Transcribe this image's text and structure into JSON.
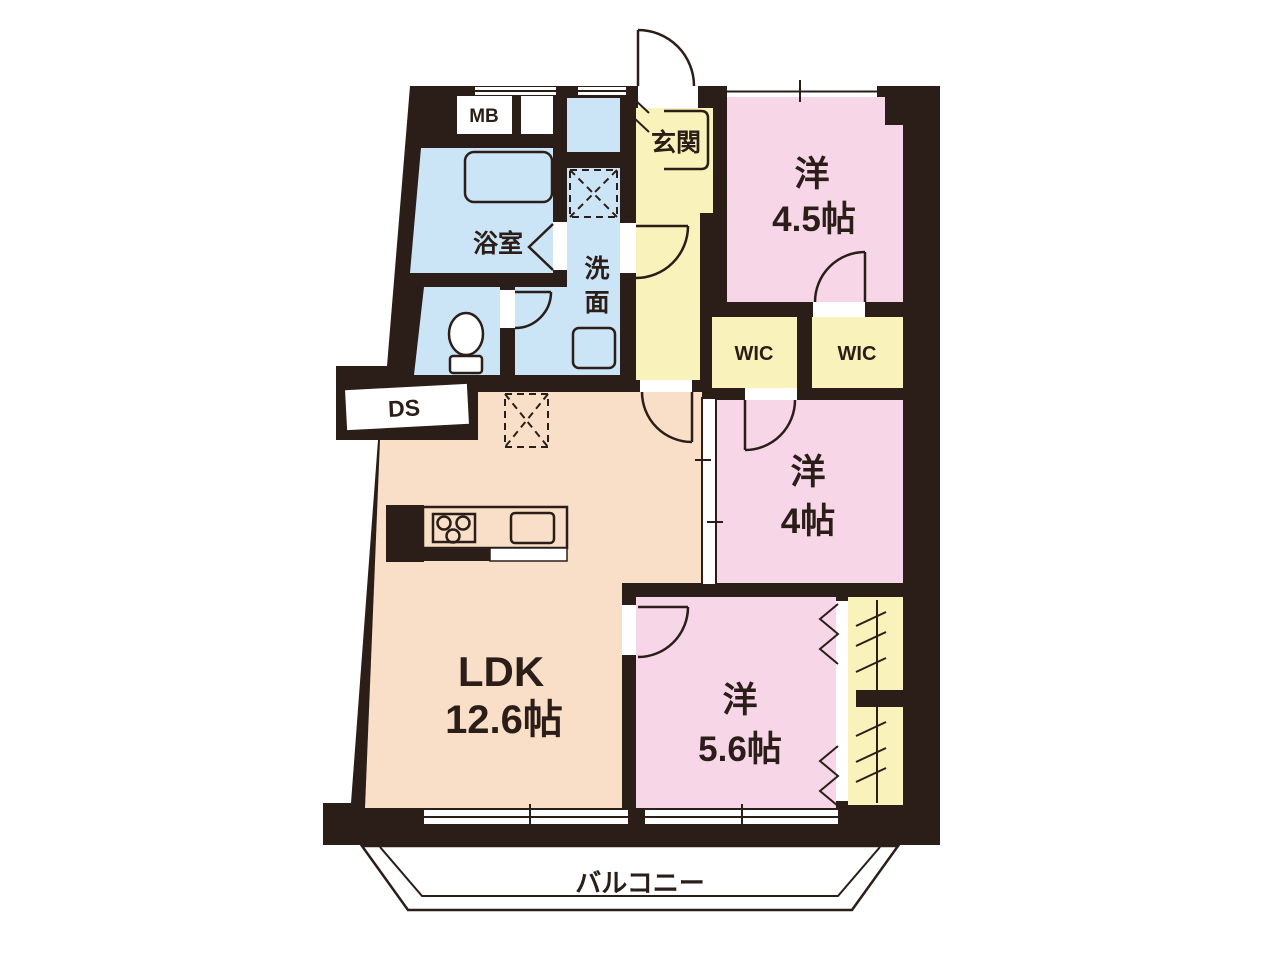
{
  "plan_type": "floor-plan",
  "colors": {
    "wall": "#2b1e18",
    "pink": "#f7d6e7",
    "peach": "#fadfc8",
    "yellow": "#f9f2bb",
    "blue": "#cbe5f7",
    "white": "#ffffff"
  },
  "rooms": {
    "western_45": {
      "name": "洋",
      "size": "4.5帖"
    },
    "western_4": {
      "name": "洋",
      "size": "4帖"
    },
    "western_56": {
      "name": "洋",
      "size": "5.6帖"
    },
    "ldk": {
      "name": "LDK",
      "size": "12.6帖"
    },
    "genkan": {
      "label": "玄関"
    },
    "bathroom": {
      "label": "浴室"
    },
    "washroom": {
      "chars": [
        "洗",
        "面"
      ]
    },
    "wic_a": {
      "label": "WIC"
    },
    "wic_b": {
      "label": "WIC"
    },
    "balcony": {
      "label": "バルコニー"
    },
    "meter_box": {
      "label": "MB"
    },
    "duct_space": {
      "label": "DS"
    }
  }
}
